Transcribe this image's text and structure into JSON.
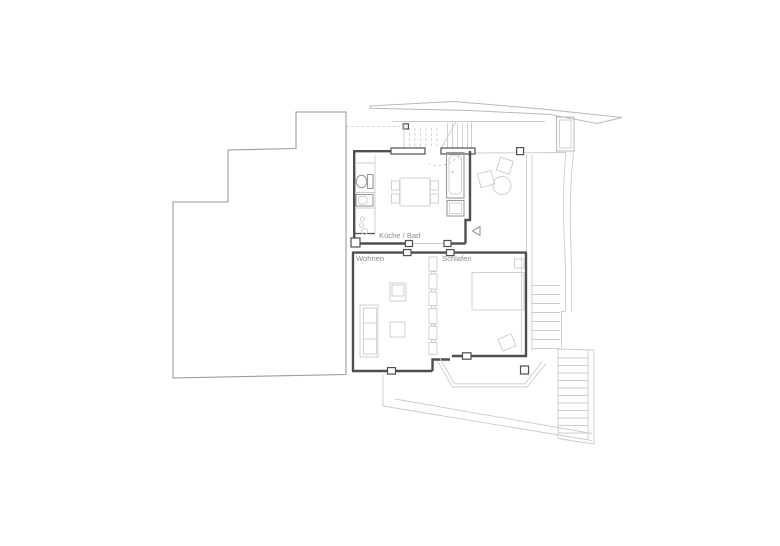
{
  "drawing": {
    "type": "architectural-floor-plan",
    "labels": {
      "kitchen_bath": "Küche / Bad",
      "living": "Wohnen",
      "sleeping": "Schlafen"
    },
    "colors": {
      "wall_dark": "#4f4f4f",
      "outline_medium": "#9a9a9a",
      "line_mid": "#b9b9b9",
      "line_light": "#cccccc",
      "label_text": "#8c8c8c"
    }
  }
}
